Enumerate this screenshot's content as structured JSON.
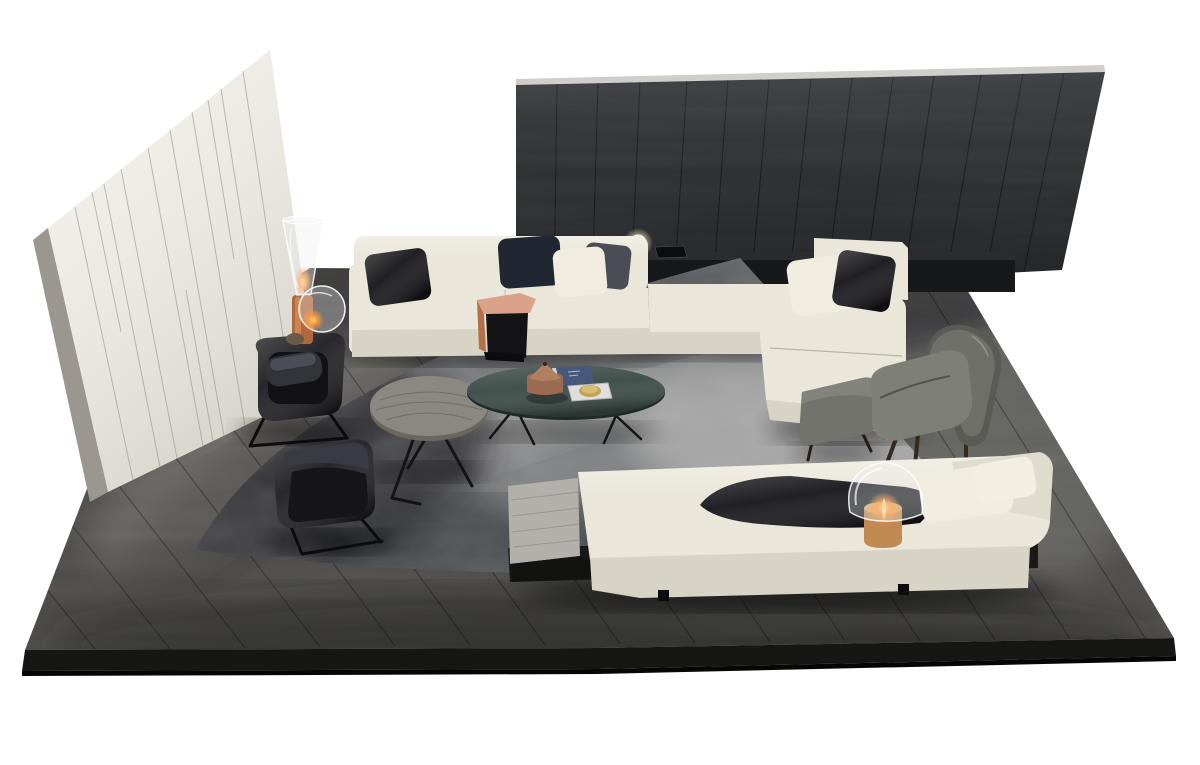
{
  "meta": {
    "scene": "studio product render of a modern living-room furniture set on a dark oak platform, viewed from a high angle, white background, no visible text",
    "background": "#ffffff"
  },
  "palette": {
    "background": "#ffffff",
    "platform_wood": "#4e4d4b",
    "platform_edge": "#161615",
    "platform_edge_dark": "#060606",
    "left_wall_face": "#eae8e0",
    "left_wall_side": "#9b978e",
    "dark_wall": "#2e3033",
    "dark_wall_top": "#cfcecb",
    "console_black": "#17181a",
    "rug_base": "#7d7e80",
    "rug_dark": "#2c2d31",
    "rug_light": "#c7c7c4",
    "sofa_cream": "#eae6d9",
    "sofa_cream_shade": "#d8d4c5",
    "pillow_black": "#17171b",
    "pillow_navy": "#202632",
    "pillow_charcoal": "#4b4d55",
    "pillow_cream": "#f0ecdf",
    "black_detail": "#141416",
    "leather_black": "#1f1f23",
    "fabric_gray": "#6f706a",
    "fabric_gray_light": "#7e7f77",
    "ottoman_gray": "#72736c",
    "table_wood_gray": "#8b8781",
    "table_teal": "#3d4c47",
    "side_table_salmon": "#dba28b",
    "side_table_cognac": "#b3714a",
    "daybed_table_gray": "#b2b0ab",
    "book_blue": "#46597a",
    "tray_white": "#dededd",
    "brass": "#c2a257",
    "bowl_terracotta": "#9c6a50",
    "lamp_copper": "#b0693c",
    "lamp_wood": "#c08a52",
    "lamp_glow": "#ff9b3d",
    "globe_white": "#f7f3ea"
  },
  "objects": [
    {
      "name": "left-wall-panel",
      "label": "cream panelled partition wall"
    },
    {
      "name": "right-wall-panel",
      "label": "dark oak plank partition wall"
    },
    {
      "name": "floor-platform",
      "label": "dark oak plank platform floor"
    },
    {
      "name": "area-rug",
      "label": "mottled grey area rug"
    },
    {
      "name": "sectional-sofa",
      "label": "cream sectional sofa with right chaise"
    },
    {
      "name": "console-shelf",
      "label": "black console shelf with sphere lamp and tray"
    },
    {
      "name": "clip-on-side-table",
      "label": "salmon and cognac leather sofa side table"
    },
    {
      "name": "daybed",
      "label": "cream daybed with grey wood end table"
    },
    {
      "name": "leather-armchair-upper",
      "label": "black leather armchair on sled base"
    },
    {
      "name": "leather-armchair-lower",
      "label": "black leather armchair on sled base"
    },
    {
      "name": "round-coffee-table",
      "label": "round grey wood coffee table"
    },
    {
      "name": "oval-coffee-table",
      "label": "oval petrol green glass coffee table"
    },
    {
      "name": "lounge-chair",
      "label": "grey fabric wing lounge chair with timber legs"
    },
    {
      "name": "ottoman",
      "label": "grey fabric ottoman"
    },
    {
      "name": "cone-floor-lamp",
      "label": "glass cone floor lamp with copper base, lit"
    },
    {
      "name": "glass-bubble-lamp",
      "label": "glass bubble lamp resting on floor, lit"
    },
    {
      "name": "mushroom-table-lamp",
      "label": "glass mushroom lamp with timber base, lit"
    },
    {
      "name": "decor-book",
      "label": "blue book on oval table"
    },
    {
      "name": "decor-lidded-bowl",
      "label": "terracotta lidded bowl on oval table"
    },
    {
      "name": "decor-tray",
      "label": "white tray with brass dish on oval table"
    }
  ]
}
